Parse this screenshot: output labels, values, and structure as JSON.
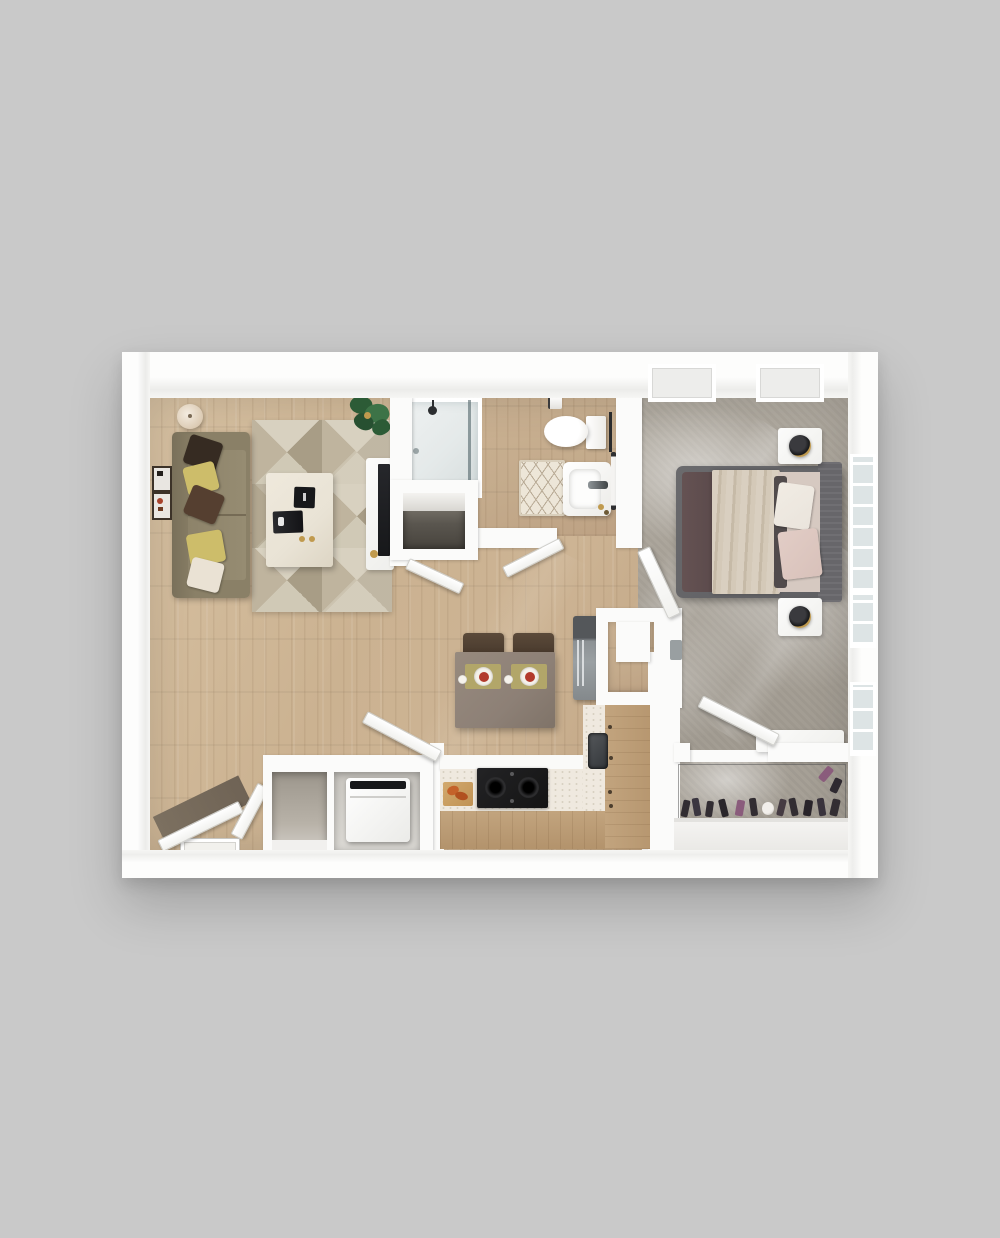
{
  "scene": {
    "type": "3d-floorplan-render",
    "title": "One-bedroom apartment 3D floor plan",
    "description": "Top-down 3D architectural rendering of a one-bedroom, one-bath apartment on a plain gray background. Living room with sofa and geometric rug at top left, bathroom top center, bedroom right, open kitchen with dining table at center bottom, entry with double doors and laundry closet bottom left, walk-in closet bottom right."
  },
  "rooms": [
    {
      "id": "living-room",
      "label": "Living Room"
    },
    {
      "id": "bathroom",
      "label": "Bathroom"
    },
    {
      "id": "bedroom",
      "label": "Bedroom"
    },
    {
      "id": "kitchen",
      "label": "Kitchen / Dining"
    },
    {
      "id": "entry",
      "label": "Entry"
    },
    {
      "id": "laundry-closet",
      "label": "Laundry / Coat Closet"
    },
    {
      "id": "walk-in-closet",
      "label": "Walk-in Closet"
    },
    {
      "id": "pantry",
      "label": "Pantry Nook"
    }
  ],
  "furniture": {
    "living_room": [
      "sofa with five throw pillows",
      "floor lamp",
      "gallery wall frames",
      "geometric area rug",
      "coffee table with tablet and remote",
      "potted plant",
      "TV media console"
    ],
    "bathroom": [
      "walk-in shower",
      "toilet",
      "toilet paper holder",
      "sink vanity",
      "towel bar",
      "diamond-pattern bath mat",
      "linen niche"
    ],
    "bedroom": [
      "queen bed with layered bedding",
      "headboard",
      "two nightstands",
      "two black-and-gold table lamps",
      "window seat",
      "windows",
      "skylights"
    ],
    "kitchen": [
      "L-shaped counter",
      "black cooktop",
      "cutting board with food",
      "under-mount sink",
      "stainless refrigerator",
      "dining table for two",
      "two chairs",
      "placemats with plates"
    ],
    "entry": [
      "double entry doors",
      "doormat"
    ],
    "laundry_closet": [
      "coat cubby",
      "washing machine",
      "closet door"
    ],
    "walk_in_closet": [
      "hanging clothes",
      "shoes",
      "wire shelf"
    ]
  },
  "palette": {
    "bg": "#c9c9c9",
    "wall": "#fbfbfa",
    "doorEdge": "#cfcfcb",
    "wood": "#cbb291",
    "woodHi": "#d7c1a2",
    "woodLo": "#bfa382",
    "bathWood": "#c4ab8c",
    "carpet": "#a8a298",
    "carpetCl": "#a29c92",
    "rugBase": "#d0c9b6",
    "rugTri": "#a89d86",
    "rugTri2": "#bfb49e",
    "sofa": "#8a8067",
    "cushion": "#968c72",
    "pilDark": "#362b22",
    "pilYellow": "#cdbd6a",
    "pilBrown": "#553f30",
    "pilCream": "#eae2d4",
    "cream": "#e9e3d5",
    "black": "#17181a",
    "brass": "#c09a4e",
    "glass": "#dde4e5",
    "showerPan": "#e4e9e9",
    "matCream": "#ede6d8",
    "matLine": "#b9ab96",
    "speckle": "#efe9df",
    "cabinet": "#c2a47e",
    "cooktop": "#141414",
    "steel": "#9aa0a3",
    "steelDark": "#54575a",
    "tableTaupe": "#8d8076",
    "chair": "#493a2d",
    "placemat": "#b2a669",
    "plateFood": "#b23a2c",
    "bedFrame": "#5f5f62",
    "headboard": "#67666a",
    "bedFoot": "#5c4b4c",
    "blanket": "#d9cfc0",
    "sheet": "#d6c9c1",
    "pillowPink": "#d8c1ba",
    "pillowWhite": "#eae4dc",
    "duvetDark": "#514b4c",
    "clothes": "#322d32",
    "clothesPurple": "#8a5c7c",
    "switchGray": "#999fa1",
    "entryDark": "#6f6355",
    "greenLeaf": "#2c5b36",
    "greenLeaf2": "#3d7347"
  }
}
